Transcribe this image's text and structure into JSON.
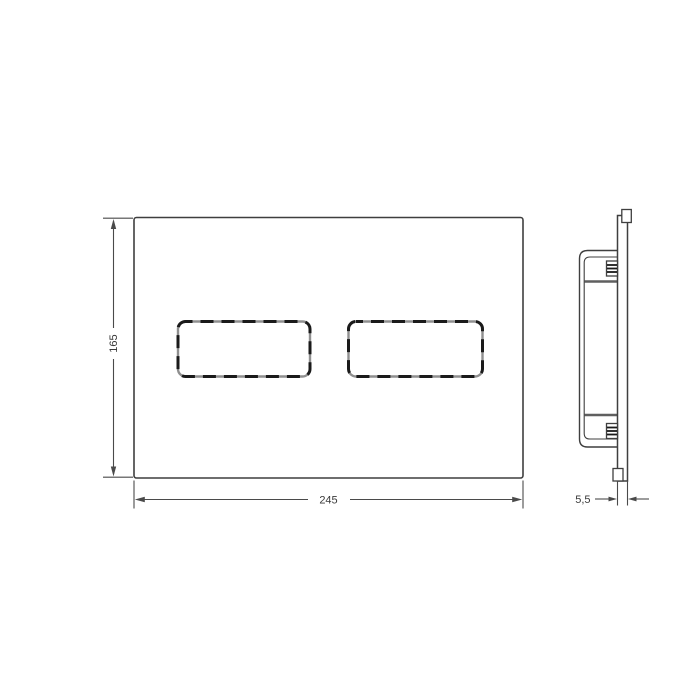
{
  "drawing": {
    "front_view": {
      "height_label": "165",
      "width_label": "245"
    },
    "side_view": {
      "thickness_label": "5,5"
    }
  },
  "colors": {
    "background": "#ffffff",
    "line": "#3f3f3f",
    "dim-line": "#4a4a4a",
    "text": "#3a3a3a",
    "button-outline": "#8f8f8f",
    "button-dash": "#1a1a1a",
    "crossbar": "#5f5f5f"
  }
}
